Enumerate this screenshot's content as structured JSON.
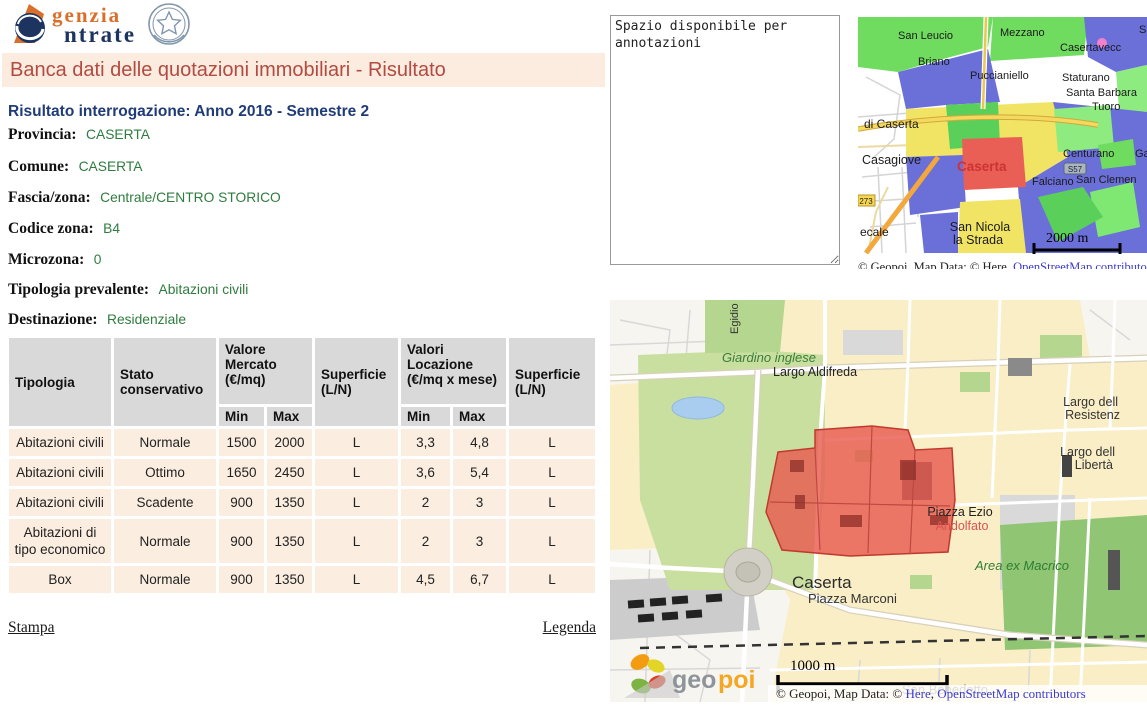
{
  "branding": {
    "logo_line1": "genzia",
    "logo_line2": "ntrate"
  },
  "title_bar": {
    "text": "Banca dati delle quotazioni immobiliari - Risultato"
  },
  "result": {
    "heading": "Risultato interrogazione: Anno 2016 - Semestre 2",
    "fields": [
      {
        "label": "Provincia:",
        "value": "CASERTA"
      },
      {
        "label": "Comune:",
        "value": "CASERTA"
      },
      {
        "label": "Fascia/zona:",
        "value": "Centrale/CENTRO STORICO"
      },
      {
        "label": "Codice zona:",
        "value": "B4"
      },
      {
        "label": "Microzona:",
        "value": "0"
      },
      {
        "label": "Tipologia prevalente:",
        "value": "Abitazioni civili"
      },
      {
        "label": "Destinazione:",
        "value": "Residenziale"
      }
    ]
  },
  "table": {
    "col_tipologia": "Tipologia",
    "col_stato": "Stato conservativo",
    "col_valore_mercato": "Valore Mercato (€/mq)",
    "col_superficie": "Superficie (L/N)",
    "col_valori_locazione": "Valori Locazione (€/mq x mese)",
    "col_superficie2": "Superficie (L/N)",
    "col_min": "Min",
    "col_max": "Max",
    "col_min2": "Min",
    "col_max2": "Max",
    "rows": [
      {
        "tipologia": "Abitazioni civili",
        "stato": "Normale",
        "vm_min": "1500",
        "vm_max": "2000",
        "sup1": "L",
        "vl_min": "3,3",
        "vl_max": "4,8",
        "sup2": "L"
      },
      {
        "tipologia": "Abitazioni civili",
        "stato": "Ottimo",
        "vm_min": "1650",
        "vm_max": "2450",
        "sup1": "L",
        "vl_min": "3,6",
        "vl_max": "5,4",
        "sup2": "L"
      },
      {
        "tipologia": "Abitazioni civili",
        "stato": "Scadente",
        "vm_min": "900",
        "vm_max": "1350",
        "sup1": "L",
        "vl_min": "2",
        "vl_max": "3",
        "sup2": "L"
      },
      {
        "tipologia": "Abitazioni di tipo economico",
        "stato": "Normale",
        "vm_min": "900",
        "vm_max": "1350",
        "sup1": "L",
        "vl_min": "2",
        "vl_max": "3",
        "sup2": "L"
      },
      {
        "tipologia": "Box",
        "stato": "Normale",
        "vm_min": "900",
        "vm_max": "1350",
        "sup1": "L",
        "vl_min": "4,5",
        "vl_max": "6,7",
        "sup2": "L"
      }
    ]
  },
  "footer_links": {
    "stampa": "Stampa",
    "legenda": "Legenda"
  },
  "annotations": {
    "text": "Spazio disponibile per annotazioni"
  },
  "colors": {
    "accent_red": "#b24b41",
    "value_green": "#2f7c3f",
    "header_navy": "#203c78",
    "zone_red": "#e8574d"
  },
  "small_map": {
    "labels": {
      "san_leucio": "San Leucio",
      "mezzano": "Mezzano",
      "s_top": "S",
      "casertavecchia": "Casertavecc",
      "briano": "Briano",
      "puccianiello": "Puccianiello",
      "staturano": "Staturano",
      "santa_barbara": "Santa Barbara",
      "tuoro": "Tuoro",
      "di_caserta": "di Caserta",
      "casagiove": "Casagiove",
      "caserta": "Caserta",
      "centurano": "Centurano",
      "ga": "Ga",
      "falciano": "Falciano",
      "san_clemente": "San Clemen",
      "ecale": "ecale",
      "sns1": "San Nicola",
      "sns2": "la Strada"
    },
    "badges": {
      "s57": "S57",
      "sp273": "273"
    },
    "scale_label": "2000 m",
    "attribution": {
      "prefix": "© Geopoi, Map Data: © Here, ",
      "osm_link": "OpenStreetMap contributors"
    }
  },
  "big_map": {
    "labels": {
      "egidio": "Egidio",
      "giardino": "Giardino inglese",
      "aldifreda": "Largo Aldifreda",
      "largo1a": "Largo dell",
      "largo1b": "Resistenz",
      "largo2a": "Largo dell",
      "largo2b": "Libertà",
      "ezio1": "Piazza Ezio",
      "ezio2": "Andolfato",
      "macrico": "Area ex Macrico",
      "caserta": "Caserta",
      "marconi": "Piazza Marconi",
      "benedetto": "San Benedetto"
    },
    "scale_label": "1000 m",
    "logo": {
      "part1": "geo",
      "part2": "poi"
    },
    "attribution": {
      "prefix": "© Geopoi, Map Data: © ",
      "here_link": "Here",
      "sep": ", ",
      "osm_link": "OpenStreetMap contributors"
    }
  }
}
